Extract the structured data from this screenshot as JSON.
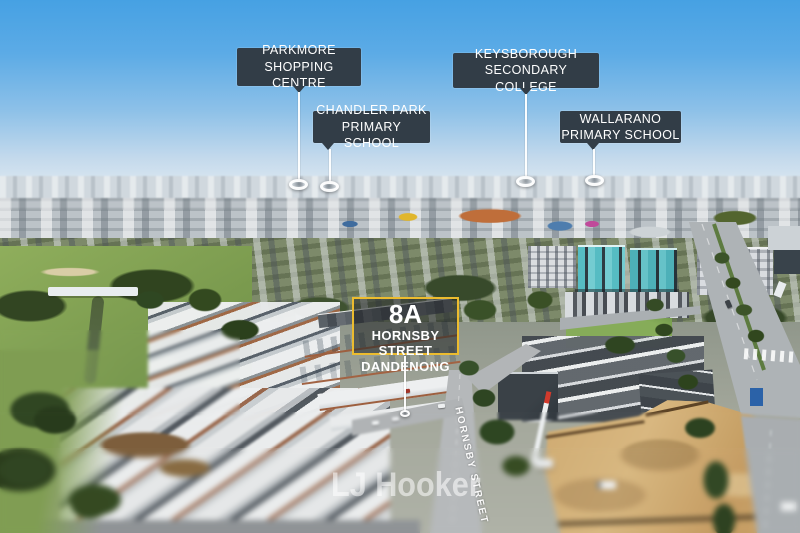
{
  "photo": {
    "watermark": "LJ Hooker",
    "street_sign": "HORNSBY STREET"
  },
  "callouts": [
    {
      "name": "parkmore-shopping-centre",
      "line1": "PARKMORE",
      "line2": "SHOPPING CENTRE"
    },
    {
      "name": "chandler-park-primary-school",
      "line1": "CHANDLER PARK",
      "line2": "PRIMARY SCHOOL"
    },
    {
      "name": "keysborough-secondary-college",
      "line1": "KEYSBOROUGH",
      "line2": "SECONDARY COLLEGE"
    },
    {
      "name": "wallarano-primary-school",
      "line1": "WALLARANO",
      "line2": "PRIMARY SCHOOL"
    }
  ],
  "property_badge": {
    "unit": "8A",
    "street": "HORNSBY STREET",
    "suburb": "DANDENONG"
  },
  "colors": {
    "callout_background": "#323d47",
    "callout_text": "#ffffff",
    "badge_border_yellow": "#ecbc2f",
    "badge_background": "rgba(33,36,38,0.55)",
    "marker_ring": "#ffffff",
    "watermark": "rgba(255,255,255,0.55)"
  }
}
